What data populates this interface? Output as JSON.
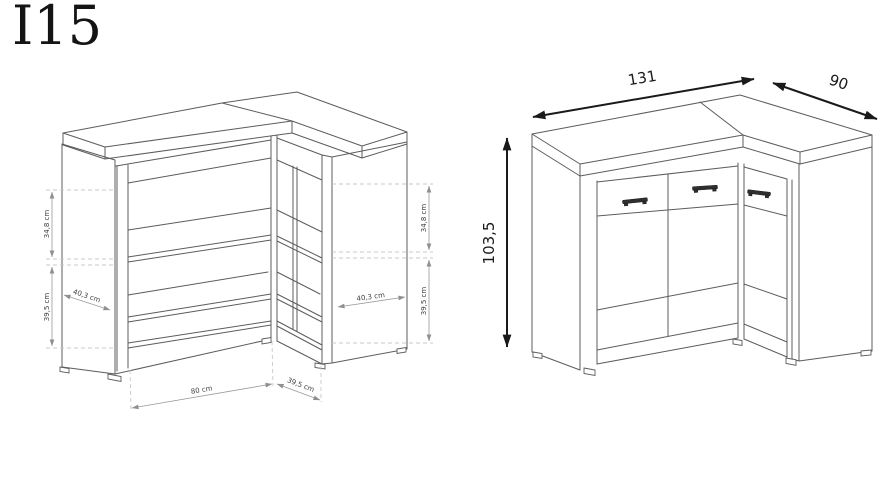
{
  "title": "I15",
  "colors": {
    "background": "#ffffff",
    "drawing_line": "#5c5c5c",
    "dimension_line": "#9a9a9a",
    "dimension_dash": "#c8c8c8",
    "dimension_text": "#3f3f3f",
    "arrow_and_number": "#1a1a1a",
    "handle_fill": "#2f2f2f"
  },
  "views": {
    "interior": {
      "label": "open corner cabinet - interior dimensions",
      "dim_left_upper": "34,8 cm",
      "dim_left_lower": "39,5 cm",
      "dim_left_depth": "40,3 cm",
      "dim_right_upper": "34,8 cm",
      "dim_right_lower": "39,5 cm",
      "dim_right_depth": "40,3 cm",
      "dim_bottom_width": "80 cm",
      "dim_bottom_depth": "39,5 cm"
    },
    "overall": {
      "label": "closed corner cabinet - overall dimensions",
      "dim_width": "131",
      "dim_depth": "90",
      "dim_height": "103,5"
    }
  }
}
